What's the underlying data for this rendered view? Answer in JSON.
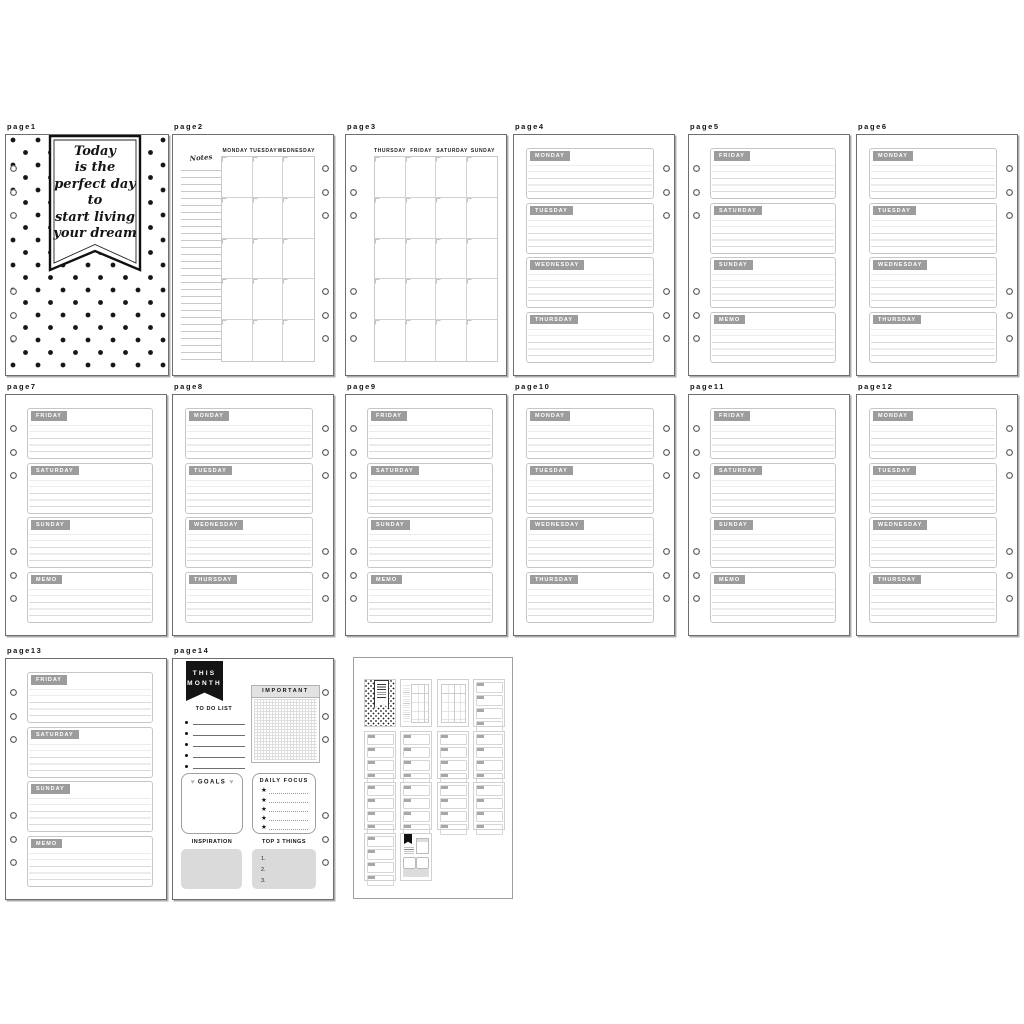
{
  "pages": {
    "p1": {
      "label": "page1",
      "cover_lines": [
        "Today",
        "is the",
        "perfect day",
        "to",
        "start living",
        "your dream"
      ]
    },
    "p2": {
      "label": "page2",
      "notes_label": "Notes",
      "columns": [
        "MONDAY",
        "TUESDAY",
        "WEDNESDAY"
      ]
    },
    "p3": {
      "label": "page3",
      "columns": [
        "THURSDAY",
        "FRIDAY",
        "SATURDAY",
        "SUNDAY"
      ]
    },
    "p4": {
      "label": "page4",
      "sections": [
        "MONDAY",
        "TUESDAY",
        "WEDNESDAY",
        "THURSDAY"
      ]
    },
    "p5": {
      "label": "page5",
      "sections": [
        "FRIDAY",
        "SATURDAY",
        "SUNDAY",
        "MEMO"
      ]
    },
    "p6": {
      "label": "page6",
      "sections": [
        "MONDAY",
        "TUESDAY",
        "WEDNESDAY",
        "THURSDAY"
      ]
    },
    "p7": {
      "label": "page7",
      "sections": [
        "FRIDAY",
        "SATURDAY",
        "SUNDAY",
        "MEMO"
      ]
    },
    "p8": {
      "label": "page8",
      "sections": [
        "MONDAY",
        "TUESDAY",
        "WEDNESDAY",
        "THURSDAY"
      ]
    },
    "p9": {
      "label": "page9",
      "sections": [
        "FRIDAY",
        "SATURDAY",
        "SUNDAY",
        "MEMO"
      ]
    },
    "p10": {
      "label": "page10",
      "sections": [
        "MONDAY",
        "TUESDAY",
        "WEDNESDAY",
        "THURSDAY"
      ]
    },
    "p11": {
      "label": "page11",
      "sections": [
        "FRIDAY",
        "SATURDAY",
        "SUNDAY",
        "MEMO"
      ]
    },
    "p12": {
      "label": "page12",
      "sections": [
        "MONDAY",
        "TUESDAY",
        "WEDNESDAY",
        "THURSDAY"
      ]
    },
    "p13": {
      "label": "page13",
      "sections": [
        "FRIDAY",
        "SATURDAY",
        "SUNDAY",
        "MEMO"
      ]
    },
    "p14": {
      "label": "page14",
      "banner_line1": "THIS",
      "banner_line2": "MONTH",
      "todo_label": "TO DO LIST",
      "important_label": "IMPORTANT",
      "goals_label": "GOALS",
      "daily_focus_label": "DAILY FOCUS",
      "inspiration_label": "INSPIRATION",
      "top3_label": "TOP 3 THINGS",
      "top3_items": [
        "1.",
        "2.",
        "3."
      ],
      "heart": "♥",
      "star": "★"
    }
  },
  "colors": {
    "day_label_gray": "#9c9c9c",
    "ruled_line_gray": "#dadada",
    "box_border_gray": "#c6c6c6",
    "fill_gray": "#dadada",
    "banner_black": "#141414"
  }
}
